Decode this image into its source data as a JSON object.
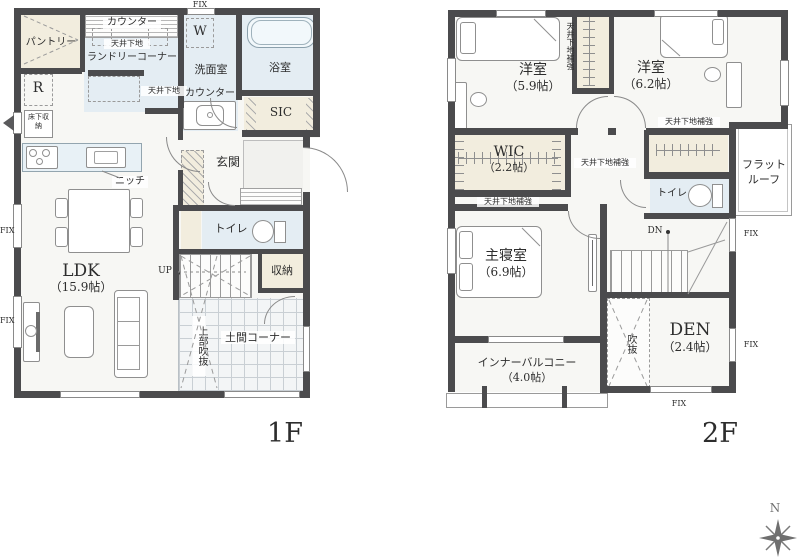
{
  "common": {
    "fix": "FIX",
    "ceiling_base": "天井下地",
    "ceiling_reinforce": "天井下地補強"
  },
  "floor1": {
    "label": "1F",
    "pantry": "パントリー",
    "counter_top": "カウンター",
    "laundry": "ランドリーコーナー",
    "washer": "W",
    "washroom": "洗面室",
    "washroom_counter": "カウンター",
    "bath": "浴室",
    "sic": "SIC",
    "fridge": "R",
    "floor_storage": "床下収納",
    "niche": "ニッチ",
    "entrance": "玄関",
    "ldk": "LDK",
    "ldk_size": "（15.9帖）",
    "toilet": "トイレ",
    "storage": "収納",
    "up": "UP",
    "doma": "土間コーナー",
    "void_above": "上部吹抜"
  },
  "floor2": {
    "label": "2F",
    "bedroom1": "洋室",
    "bedroom1_size": "（5.9帖）",
    "bedroom2": "洋室",
    "bedroom2_size": "（6.2帖）",
    "wic": "WIC",
    "wic_size": "（2.2帖）",
    "toilet": "トイレ",
    "flat_roof_line1": "フラット",
    "flat_roof_line2": "ルーフ",
    "master": "主寝室",
    "master_size": "（6.9帖）",
    "dn": "DN",
    "void": "吹抜",
    "den": "DEN",
    "den_size": "（2.4帖）",
    "balcony": "インナーバルコニー",
    "balcony_size": "（4.0帖）"
  },
  "compass": {
    "north": "N"
  }
}
